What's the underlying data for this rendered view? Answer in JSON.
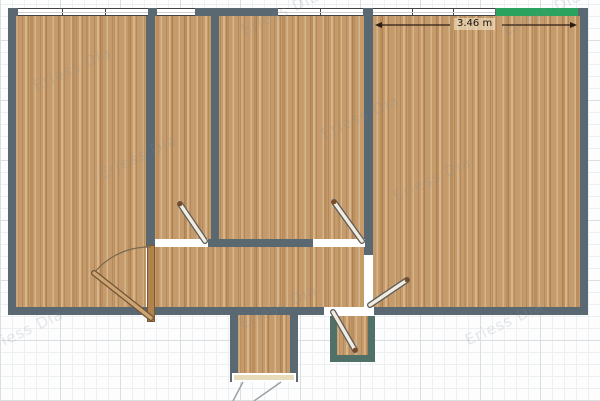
{
  "canvas": {
    "width": 600,
    "height": 401
  },
  "dimension": {
    "label": "3.46 m",
    "x1": 375,
    "x2": 577,
    "y": 25
  },
  "watermark": {
    "text": "Eriess Dia",
    "angle": -25,
    "positions": [
      [
        -18,
        322
      ],
      [
        236,
        298
      ],
      [
        462,
        314
      ],
      [
        96,
        148
      ],
      [
        318,
        108
      ],
      [
        238,
        4
      ],
      [
        500,
        4
      ],
      [
        30,
        60
      ],
      [
        390,
        170
      ]
    ]
  },
  "colors": {
    "wall": "#5a6872",
    "wall_wc": "#507068",
    "highlight_green": "#2ba35e",
    "wood_base": "#c69b6c",
    "grid_minor": "#edf0f2",
    "grid_major": "#d9dee2",
    "door_open": "#ffffff",
    "door_leaf_fill": "#f2ecdf",
    "door_leaf_edge": "#5c5c5c",
    "door_handle": "#7b4a20",
    "door_closed_leaf": "#b1824b",
    "balcony_door_panel": "#e7dbb9",
    "dim_line": "#2c1d12",
    "watermark": "#7f8c98"
  },
  "floors": [
    {
      "name": "floor-main",
      "x": 16,
      "y": 16,
      "w": 564,
      "h": 291
    },
    {
      "name": "floor-balcony",
      "x": 238,
      "y": 315,
      "w": 52,
      "h": 58
    },
    {
      "name": "floor-wc",
      "x": 337,
      "y": 316,
      "w": 31,
      "h": 39
    }
  ],
  "walls": [
    {
      "name": "wall-exterior-top",
      "x": 8,
      "y": 8,
      "w": 580,
      "h": 8
    },
    {
      "name": "wall-exterior-bottom",
      "x": 8,
      "y": 307,
      "w": 580,
      "h": 8
    },
    {
      "name": "wall-exterior-left",
      "x": 8,
      "y": 16,
      "w": 8,
      "h": 291
    },
    {
      "name": "wall-exterior-right",
      "x": 580,
      "y": 16,
      "w": 8,
      "h": 291
    },
    {
      "name": "wall-interior-a",
      "x": 146,
      "y": 16,
      "w": 9,
      "h": 231
    },
    {
      "name": "wall-interior-b",
      "x": 211,
      "y": 16,
      "w": 8,
      "h": 231
    },
    {
      "name": "wall-interior-c",
      "x": 364,
      "y": 16,
      "w": 9,
      "h": 291
    },
    {
      "name": "wall-interior-hall",
      "x": 146,
      "y": 239,
      "w": 227,
      "h": 8
    },
    {
      "name": "wall-balcony-left",
      "x": 230,
      "y": 315,
      "w": 8,
      "h": 67
    },
    {
      "name": "wall-balcony-right",
      "x": 290,
      "y": 315,
      "w": 8,
      "h": 67
    },
    {
      "name": "wall-wc-left",
      "x": 330,
      "y": 316,
      "w": 7,
      "h": 46,
      "tint": "wc"
    },
    {
      "name": "wall-wc-right",
      "x": 368,
      "y": 316,
      "w": 7,
      "h": 46,
      "tint": "wc"
    },
    {
      "name": "wall-wc-bottom",
      "x": 330,
      "y": 355,
      "w": 45,
      "h": 7,
      "tint": "wc"
    }
  ],
  "green_segment": {
    "name": "wall-segment-highlighted",
    "x": 496,
    "y": 8,
    "w": 82,
    "h": 8
  },
  "windows": [
    {
      "name": "window-top-1",
      "x": 18,
      "w": 130,
      "dividers": [
        44,
        87
      ]
    },
    {
      "name": "window-top-2",
      "x": 157,
      "w": 38,
      "dividers": []
    },
    {
      "name": "window-top-3",
      "x": 278,
      "w": 85,
      "dividers": [
        42
      ]
    },
    {
      "name": "window-top-4",
      "x": 373,
      "w": 122,
      "dividers": [
        39,
        80
      ]
    }
  ],
  "door_openings": [
    {
      "name": "door-opening-room2",
      "x": 155,
      "y": 239,
      "w": 53,
      "h": 8
    },
    {
      "name": "door-opening-room3",
      "x": 313,
      "y": 239,
      "w": 52,
      "h": 8
    },
    {
      "name": "door-opening-hall-room4",
      "x": 364,
      "y": 255,
      "w": 9,
      "h": 52
    },
    {
      "name": "door-opening-wc",
      "x": 324,
      "y": 307,
      "w": 50,
      "h": 9
    },
    {
      "name": "door-opening-room1",
      "x": 146,
      "y": 247,
      "w": 9,
      "h": 60
    }
  ],
  "door_leaves": [
    {
      "name": "door-leaf-room2",
      "x1": 205,
      "y1": 241,
      "x2": 180,
      "y2": 204
    },
    {
      "name": "door-leaf-room3",
      "x1": 362,
      "y1": 241,
      "x2": 334,
      "y2": 202
    },
    {
      "name": "door-leaf-hall-room4",
      "x1": 370,
      "y1": 305,
      "x2": 407,
      "y2": 280
    },
    {
      "name": "door-leaf-wc",
      "x1": 333,
      "y1": 312,
      "x2": 355,
      "y2": 350
    }
  ],
  "room1_door": {
    "closed_leaf": {
      "x": 147,
      "y": 245,
      "w": 8,
      "h": 77
    },
    "arc": {
      "x1": 151,
      "y1": 247,
      "r": 71,
      "x2": 94,
      "y2": 273
    },
    "open_leaf": {
      "x1": 151,
      "y1": 318,
      "x2": 94,
      "y2": 273
    }
  },
  "balcony_door": {
    "strip": {
      "x": 232,
      "y": 373,
      "w": 64,
      "h": 9
    },
    "panel": {
      "x": 234,
      "y": 375,
      "w": 60,
      "h": 5
    },
    "swing_lines": [
      [
        243,
        382,
        233,
        401
      ],
      [
        281,
        382,
        254,
        401
      ]
    ]
  }
}
